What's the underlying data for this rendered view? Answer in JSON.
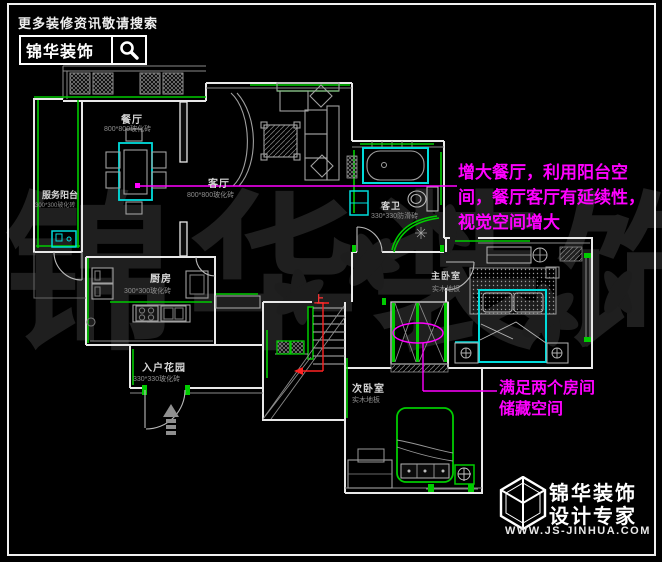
{
  "header": {
    "tagline": "更多装修资讯敬请搜索",
    "brand": "锦华装饰"
  },
  "watermark": "锦华装饰",
  "plan": {
    "rooms": {
      "dining": {
        "name": "餐厅",
        "material": "800*800玻化砖"
      },
      "living": {
        "name": "客厅",
        "material": "800*800玻化砖"
      },
      "service_balcony": {
        "name": "服务阳台",
        "material": "300*300玻化砖"
      },
      "guest_bath": {
        "name": "客卫",
        "material": "330*330防滑砖"
      },
      "kitchen": {
        "name": "厨房",
        "material": "300*300玻化砖"
      },
      "entry_garden": {
        "name": "入户花园",
        "material": "330*330玻化砖"
      },
      "master_bedroom": {
        "name": "主卧室",
        "material": "实木地板"
      },
      "second_bedroom": {
        "name": "次卧室",
        "material": "实木地板"
      }
    },
    "stairs": {
      "up_label": "上"
    }
  },
  "annotations": {
    "balcony_note": {
      "lines": [
        "增大餐厅，利用阳台空",
        "间，餐厅客厅有延续性，",
        "视觉空间增大"
      ]
    },
    "storage_note": {
      "lines": [
        "满足两个房间",
        "储藏空间"
      ]
    }
  },
  "footer": {
    "brand": "锦华装饰",
    "subtitle": "设计专家",
    "url": "WWW.JS-JINHUA.COM"
  },
  "colors": {
    "background": "#000000",
    "wall_white": "#e8e8e8",
    "accent_green": "#00cc00",
    "fixture_cyan": "#00dcdc",
    "annotation_magenta": "#ff00ff",
    "stair_red": "#ff2222",
    "furniture_gray": "#9a9a9a",
    "watermark_gray": "#1f1f1f"
  }
}
